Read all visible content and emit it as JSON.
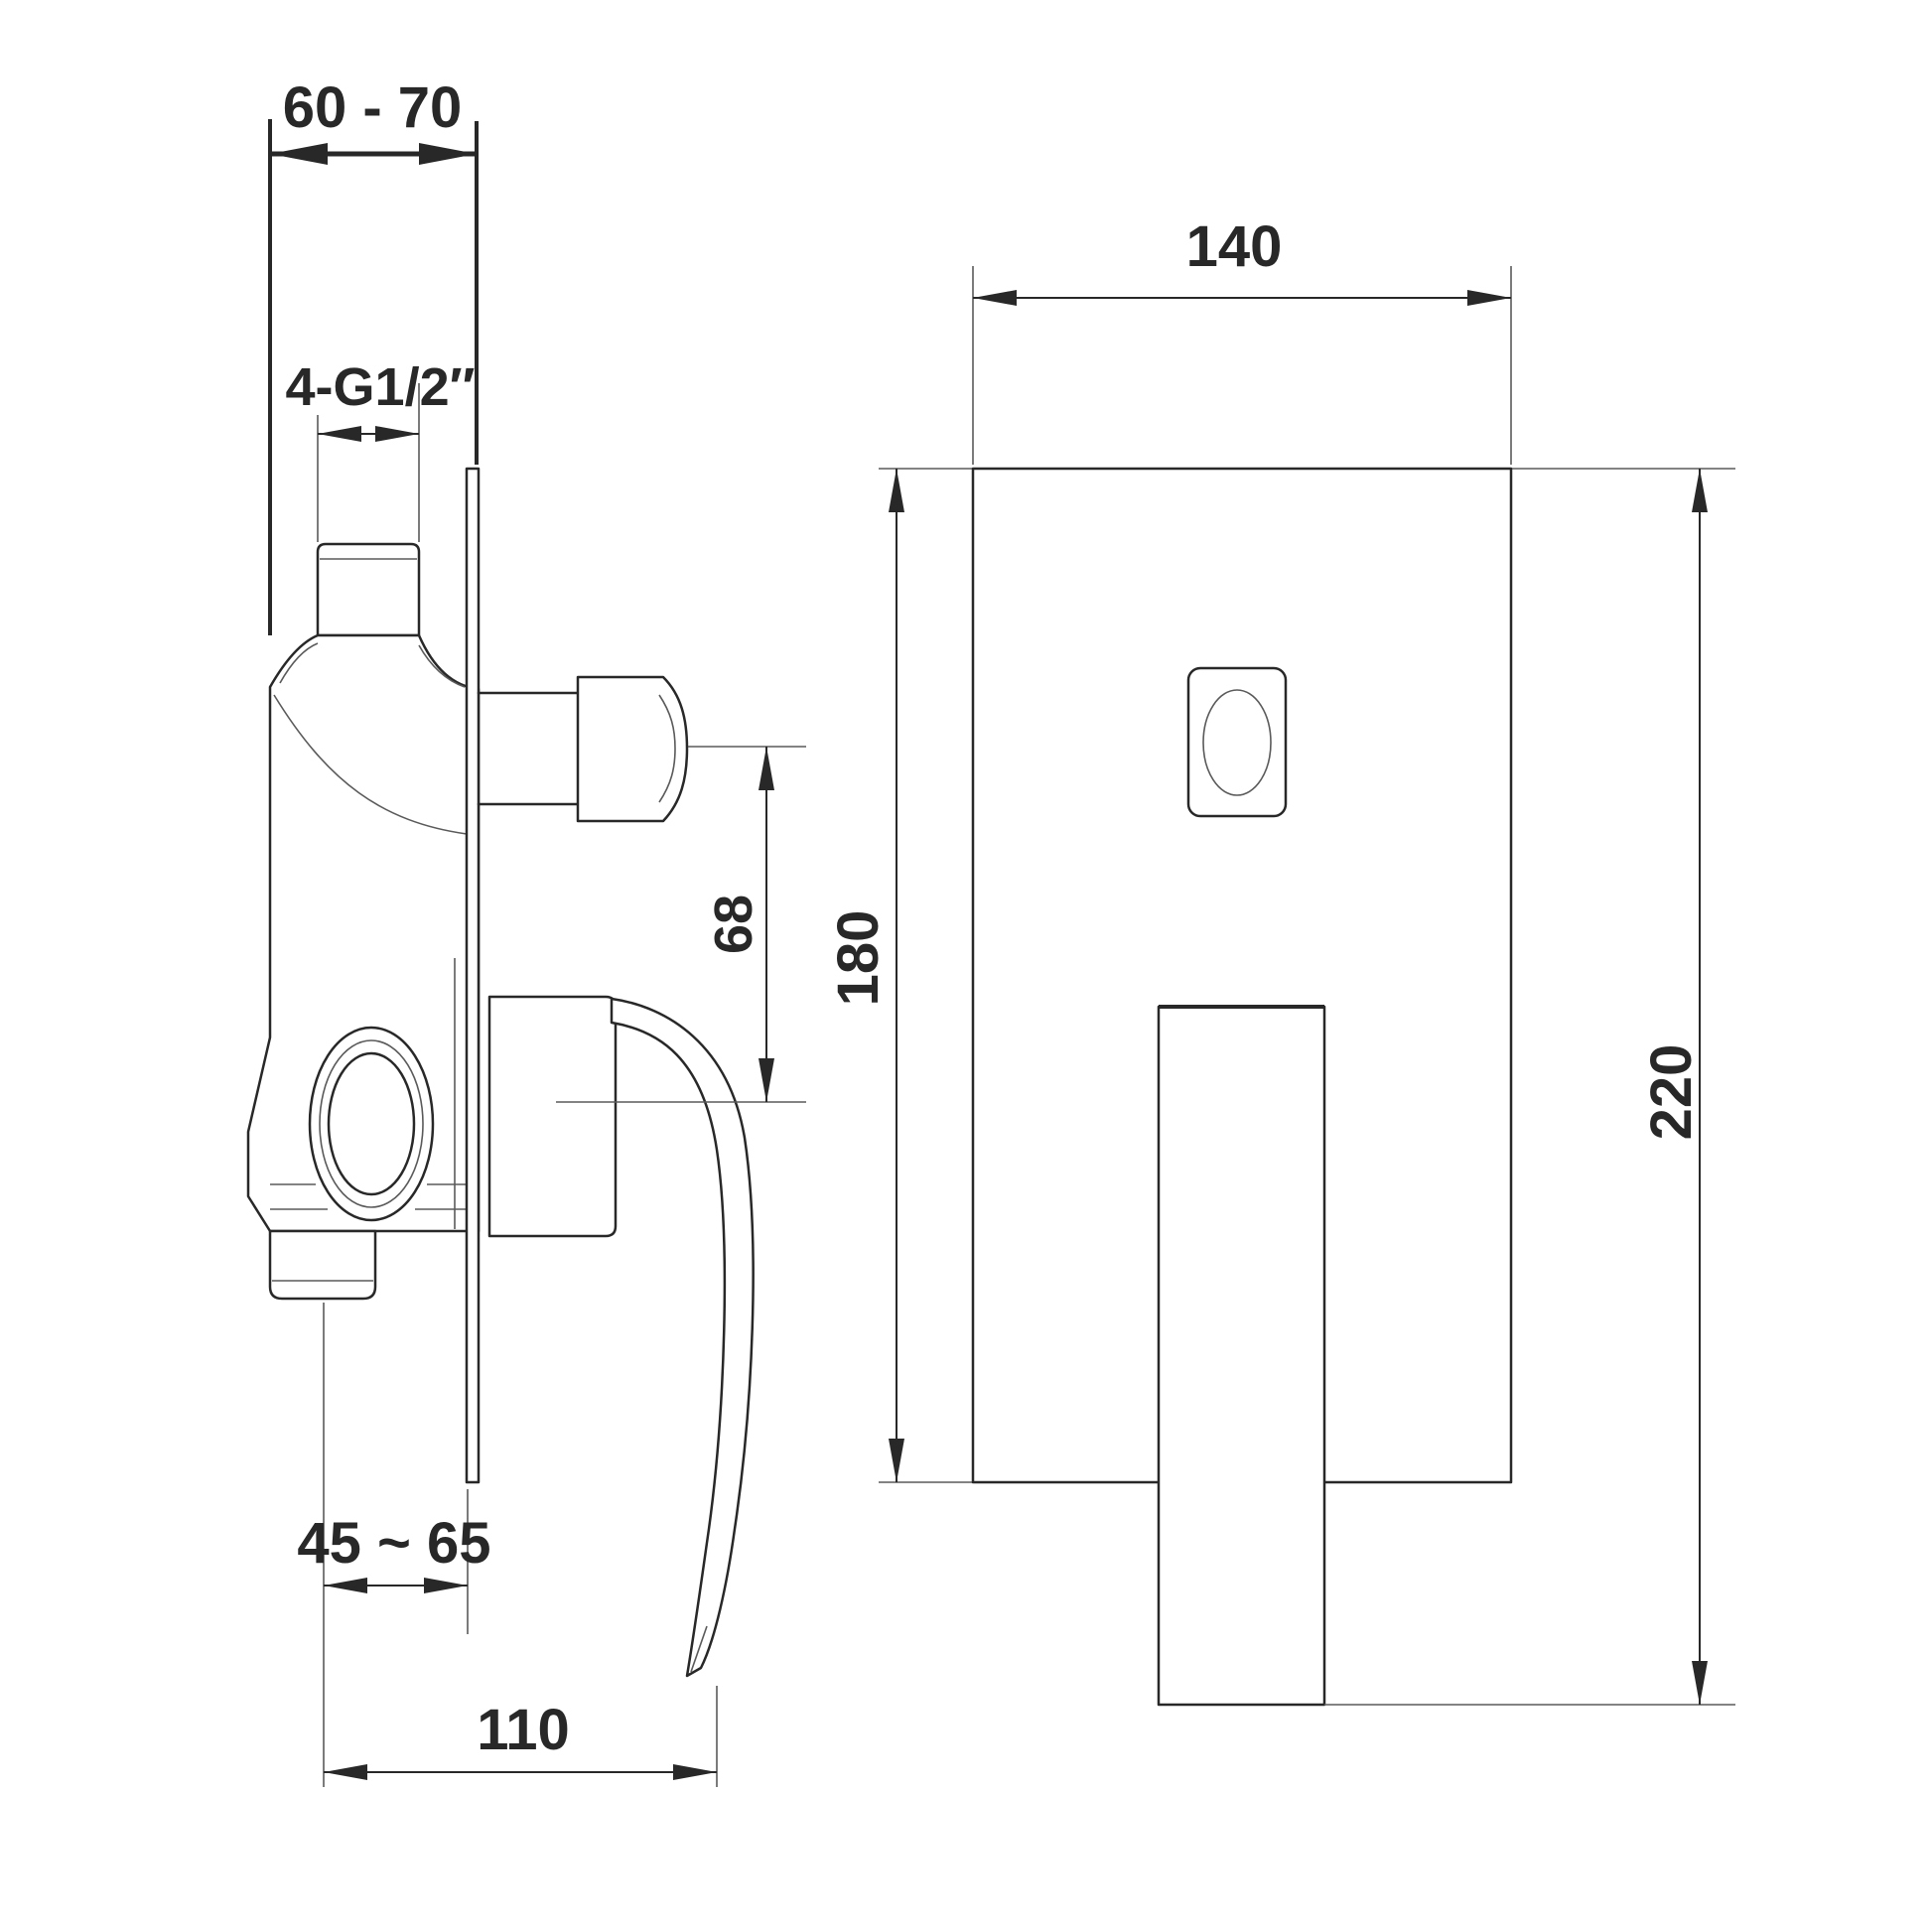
{
  "colors": {
    "background": "#ffffff",
    "ink": "#282828",
    "thin_line": "#5a5a5a"
  },
  "side_view": {
    "dims": {
      "mount_depth_range": "60 - 70",
      "thread_size": "4-G1/2″",
      "handle_center_offset": "68",
      "rough_in_range": "45 ~ 65",
      "handle_reach": "110"
    }
  },
  "front_view": {
    "dims": {
      "plate_width": "140",
      "plate_height": "180",
      "overall_height": "220"
    }
  }
}
